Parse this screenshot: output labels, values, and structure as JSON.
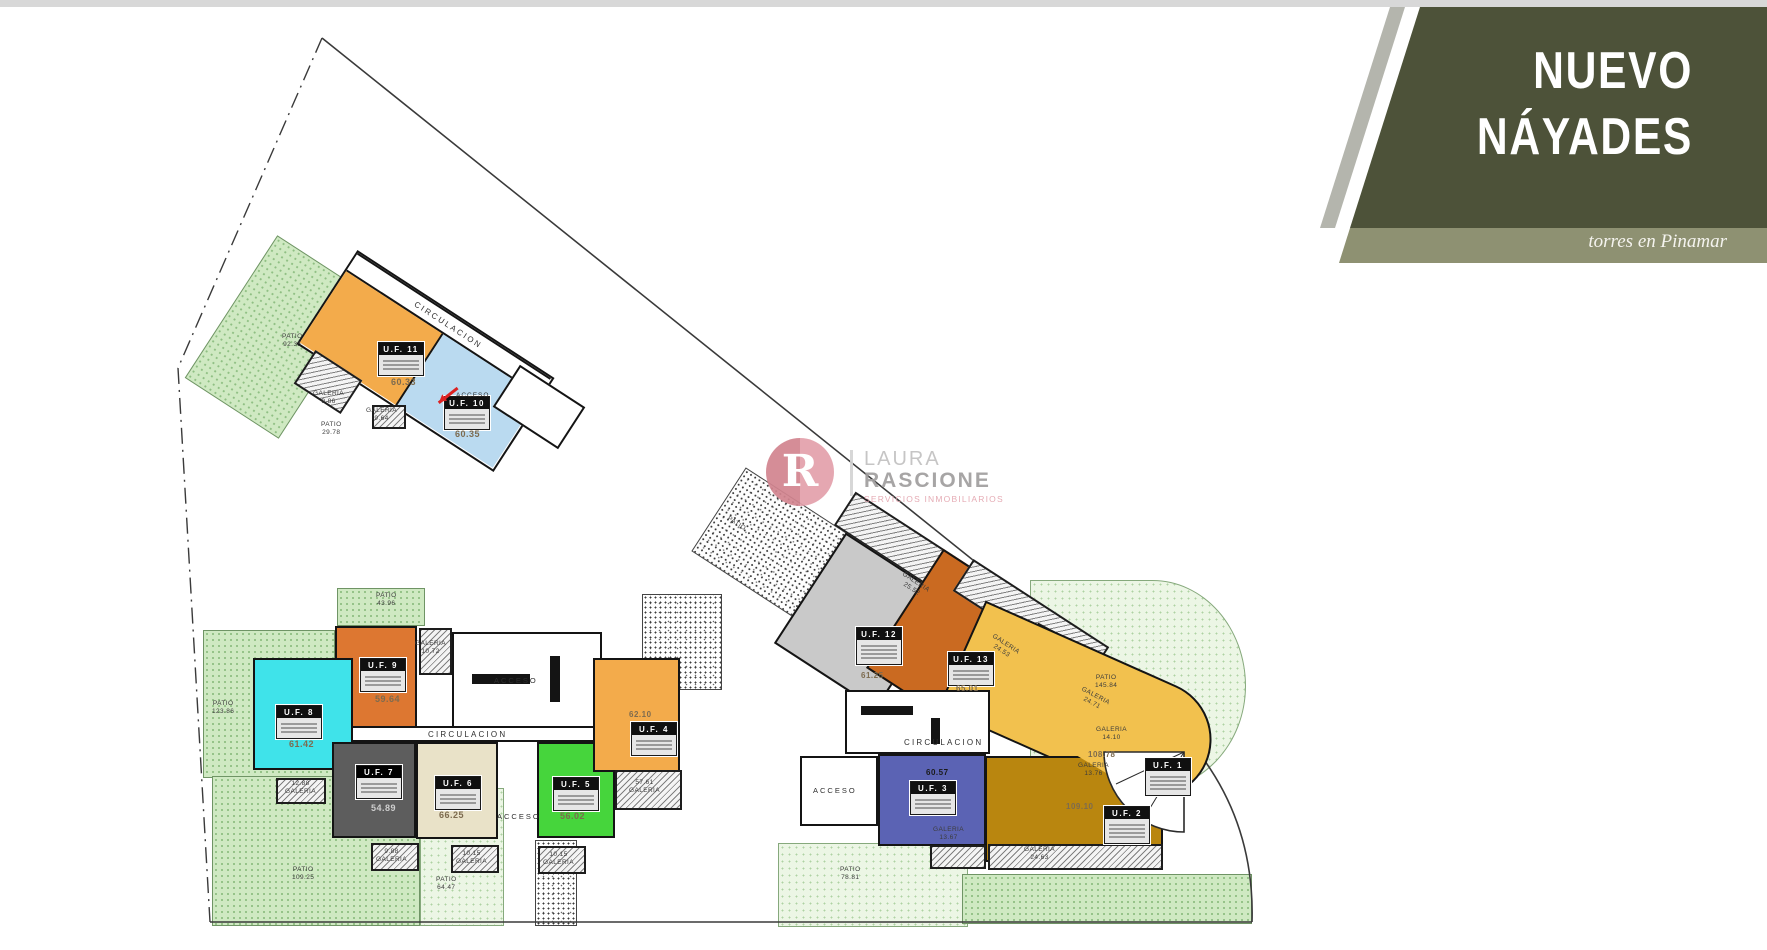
{
  "banner": {
    "title_line1": "NUEVO",
    "title_line2": "NÁYADES",
    "subtitle": "torres en Pinamar",
    "color_dark": "#4d5239",
    "color_band": "#8e9172",
    "color_stripe": "#b4b5ad"
  },
  "watermark": {
    "monogram": "R",
    "line1": "LAURA",
    "line2": "RASCIONE",
    "tagline": "SERVICIOS INMOBILIARIOS",
    "color_pink": "#dd93a0"
  },
  "plan": {
    "words": {
      "circulacion": "CIRCULACION",
      "acceso": "ACCESO",
      "galeria": "GALERIA",
      "patio": "PATIO"
    },
    "units": {
      "uf1": {
        "label": "U.F.  1",
        "area": "108.78",
        "color": "#f2c14e"
      },
      "uf2": {
        "label": "U.F.  2",
        "area": "109.10",
        "color": "#b9860f"
      },
      "uf3": {
        "label": "U.F.  3",
        "area": "60.57",
        "color": "#5b63b4"
      },
      "uf4": {
        "label": "U.F.  4",
        "area": "62.10",
        "color": "#f3ab4b"
      },
      "uf5": {
        "label": "U.F.  5",
        "area": "56.02",
        "color": "#46d53c"
      },
      "uf6": {
        "label": "U.F.  6",
        "area": "66.25",
        "color": "#e9e2c8"
      },
      "uf7": {
        "label": "U.F.  7",
        "area": "54.89",
        "color": "#5d5d5d"
      },
      "uf8": {
        "label": "U.F.  8",
        "area": "61.42",
        "color": "#3fe3ea"
      },
      "uf9": {
        "label": "U.F.  9",
        "area": "59.64",
        "color": "#dd7731"
      },
      "uf10": {
        "label": "U.F.  10",
        "area": "60.35",
        "color": "#badaf0"
      },
      "uf11": {
        "label": "U.F.  11",
        "area": "60.33",
        "color": "#f3ab4b"
      },
      "uf12": {
        "label": "U.F.  12",
        "area": "61.25",
        "color": "#c9c9c9"
      },
      "uf13": {
        "label": "U.F.  13",
        "area": "65.01",
        "color": "#ca6a21"
      }
    },
    "galeria_values": [
      "9.86",
      "9.64",
      "10.72",
      "12.88",
      "9.88",
      "10.15",
      "10.15",
      "57.61",
      "25.52",
      "24.53",
      "24.71",
      "13.67",
      "24.63",
      "14.10",
      "13.76"
    ],
    "patio_values": [
      "92.35",
      "29.78",
      "43.96",
      "123.86",
      "109.25",
      "64.47",
      "78.81",
      "145.84"
    ]
  }
}
